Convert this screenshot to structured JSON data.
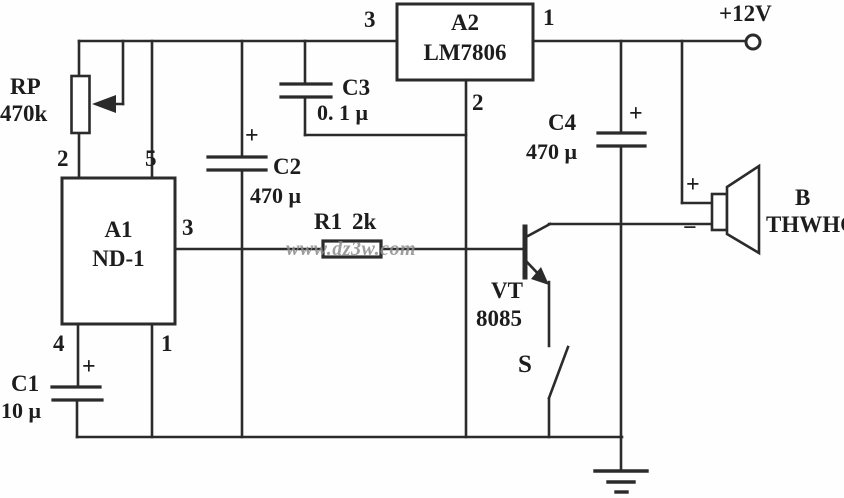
{
  "schematic": {
    "watermark": "www.dz3w.com",
    "power_label": "+12V",
    "rp": {
      "ref": "RP",
      "value": "470k"
    },
    "a1": {
      "ref": "A1",
      "model": "ND-1",
      "pin2": "2",
      "pin5": "5",
      "pin3": "3",
      "pin4": "4",
      "pin1": "1"
    },
    "a2": {
      "ref": "A2",
      "model": "LM7806",
      "pin3": "3",
      "pin1": "1",
      "pin2": "2"
    },
    "c1": {
      "ref": "C1",
      "value": "10 μ",
      "plus": "+"
    },
    "c2": {
      "ref": "C2",
      "value": "470 μ",
      "plus": "+"
    },
    "c3": {
      "ref": "C3",
      "value": "0. 1 μ"
    },
    "c4": {
      "ref": "C4",
      "value": "470 μ",
      "plus": "+"
    },
    "r1": {
      "ref": "R1",
      "value": "2k"
    },
    "vt": {
      "ref": "VT",
      "model": "8085"
    },
    "s": {
      "ref": "S"
    },
    "b": {
      "ref": "B",
      "model": "THWHC",
      "plus": "+",
      "minus": "−"
    }
  }
}
